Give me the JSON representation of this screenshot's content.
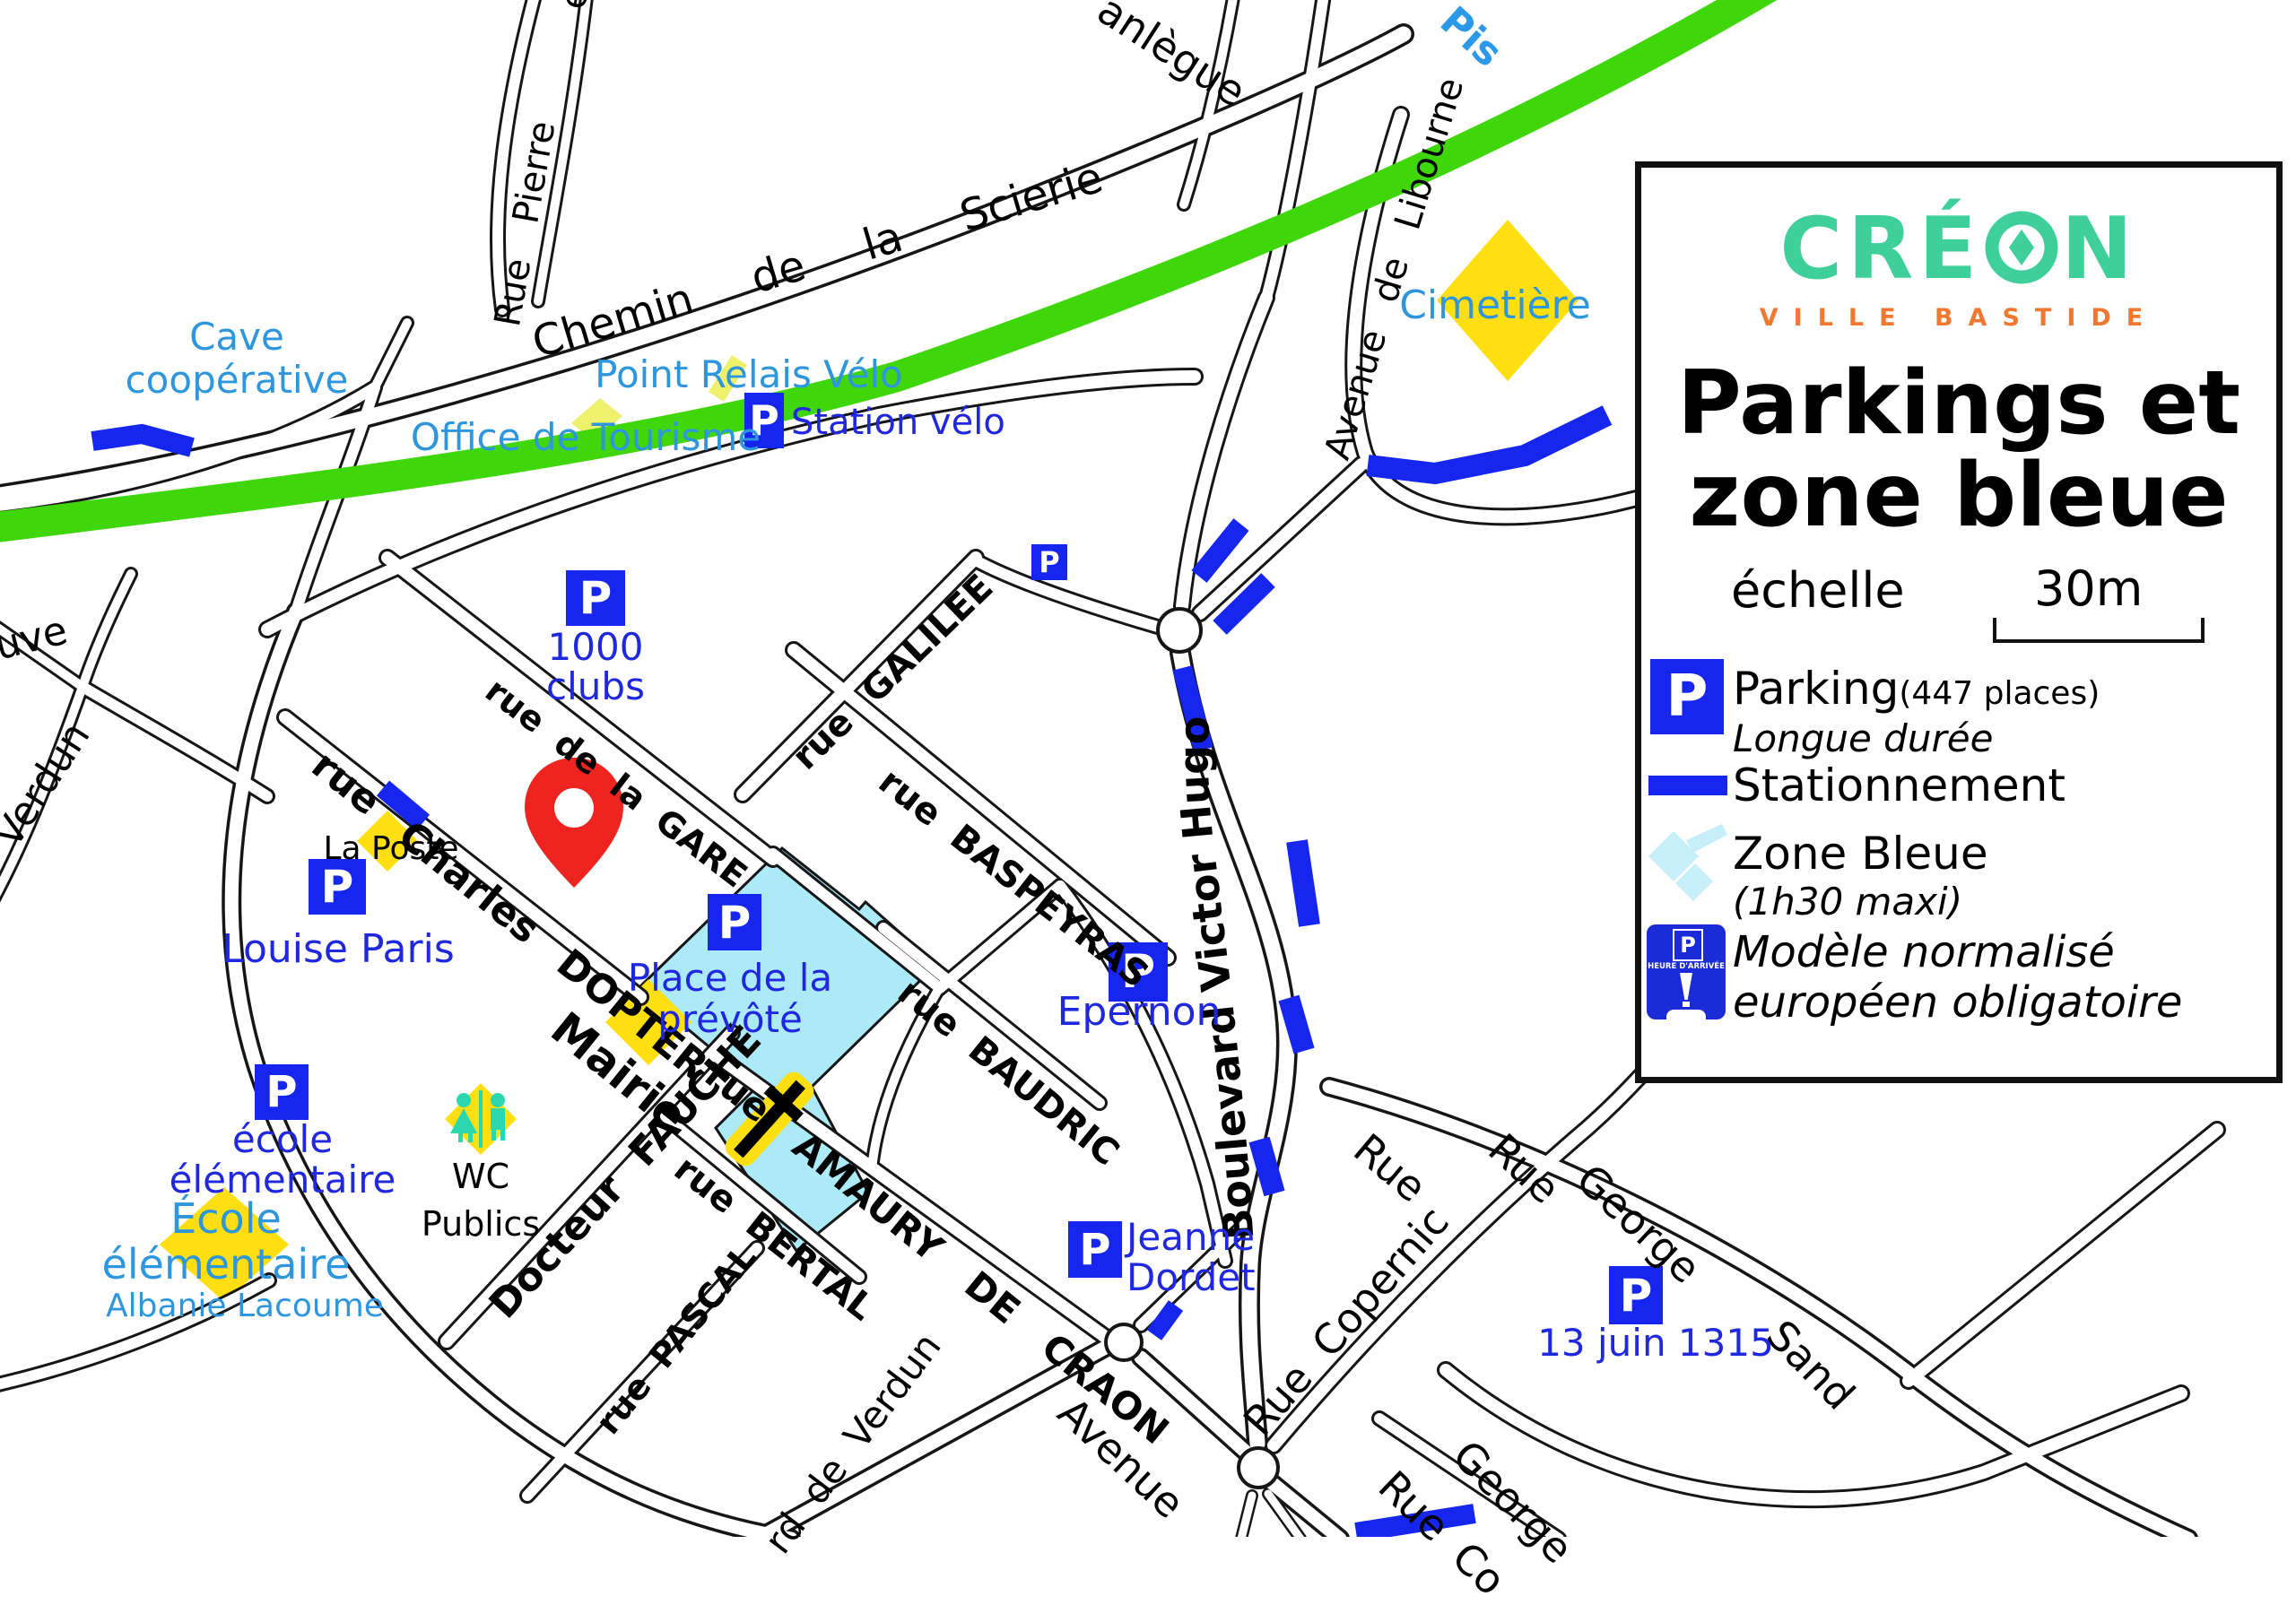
{
  "colors": {
    "poi_light_blue": "#2e96dd",
    "poi_dark_blue": "#1f28de",
    "parking_blue": "#1626ee",
    "piste_green": "#3fd60a",
    "zone_cyan": "#aceaf7",
    "landmark_yellow": "#ffdf10",
    "pale_yellow": "#edf16c",
    "pin_red": "#ee2420",
    "wc_teal": "#2bd8ae",
    "logo_green": "#3ecf9a",
    "logo_orange": "#f07830"
  },
  "legend": {
    "logo_part1": "CRÉ",
    "logo_part2": "N",
    "subtitle": "VILLE BASTIDE",
    "title": "Parkings et\nzone bleue",
    "scale_label": "échelle",
    "scale_value": "30m",
    "parking_label": "Parking",
    "parking_places": "(447 places)",
    "parking_sub": "Longue durée",
    "stationnement_label": "Stationnement",
    "zone_label": "Zone Bleue",
    "zone_sub": "(1h30 maxi)",
    "disc_caption": "HEURE D'ARRIVÉE",
    "modele_label": "Modèle normalisé\neuropéen obligatoire",
    "p": "P"
  },
  "map": {
    "icons": {
      "p": "P"
    },
    "streets": {
      "sanlegue": "anlègue",
      "piste": "Pis",
      "et": "et",
      "rue_pierre": "Rue Pierre",
      "chemin": "Chemin de la Scierie",
      "libourne": "Avenue de Libourne",
      "gare": "rue de la GARE",
      "galilee": "rue GALILEE",
      "baspeyras": "rue BASPEYRAS",
      "hugo": "Boulevard Victor Hugo",
      "dopter": "rue Charles DOPTER",
      "mairie": "Mairie",
      "baudric": "rue BAUDRIC",
      "amaury": "rue AMAURY DE CRAON",
      "bertal": "rue BERTAL",
      "fauche": "Docteur FAUCHÉ",
      "pascal": "rue PASCAL",
      "verdun_blvd": "rd de Verdun",
      "avenue": "Avenue",
      "copernic": "Rue Copernic",
      "rue_a": "Rue",
      "rue_b": "Rue",
      "george_a": "George",
      "sand": "Sand",
      "george_b": "George",
      "rue_co": "Rue Co",
      "neuve": "uve",
      "verdun_left": "Verdun"
    },
    "pois": {
      "cave": "Cave\ncoopérative",
      "office": "Office de Tourisme",
      "point_relais": "Point Relais Vélo",
      "station_velo": "Station vélo",
      "cimetiere": "Cimetière",
      "clubs": "1000\nclubs",
      "la_poste": "La Poste",
      "louise": "Louise Paris",
      "prevote": "Place de la\nprévôté",
      "epernon": "Epernon",
      "ecole_p": "école\nélémentaire",
      "wc": "WC\nPublics",
      "ecole_y": "École\nélémentaire",
      "lacoume": "Albanie Lacoume",
      "dordet": "Jeanne\nDordet",
      "juin": "13 juin 1315"
    }
  }
}
